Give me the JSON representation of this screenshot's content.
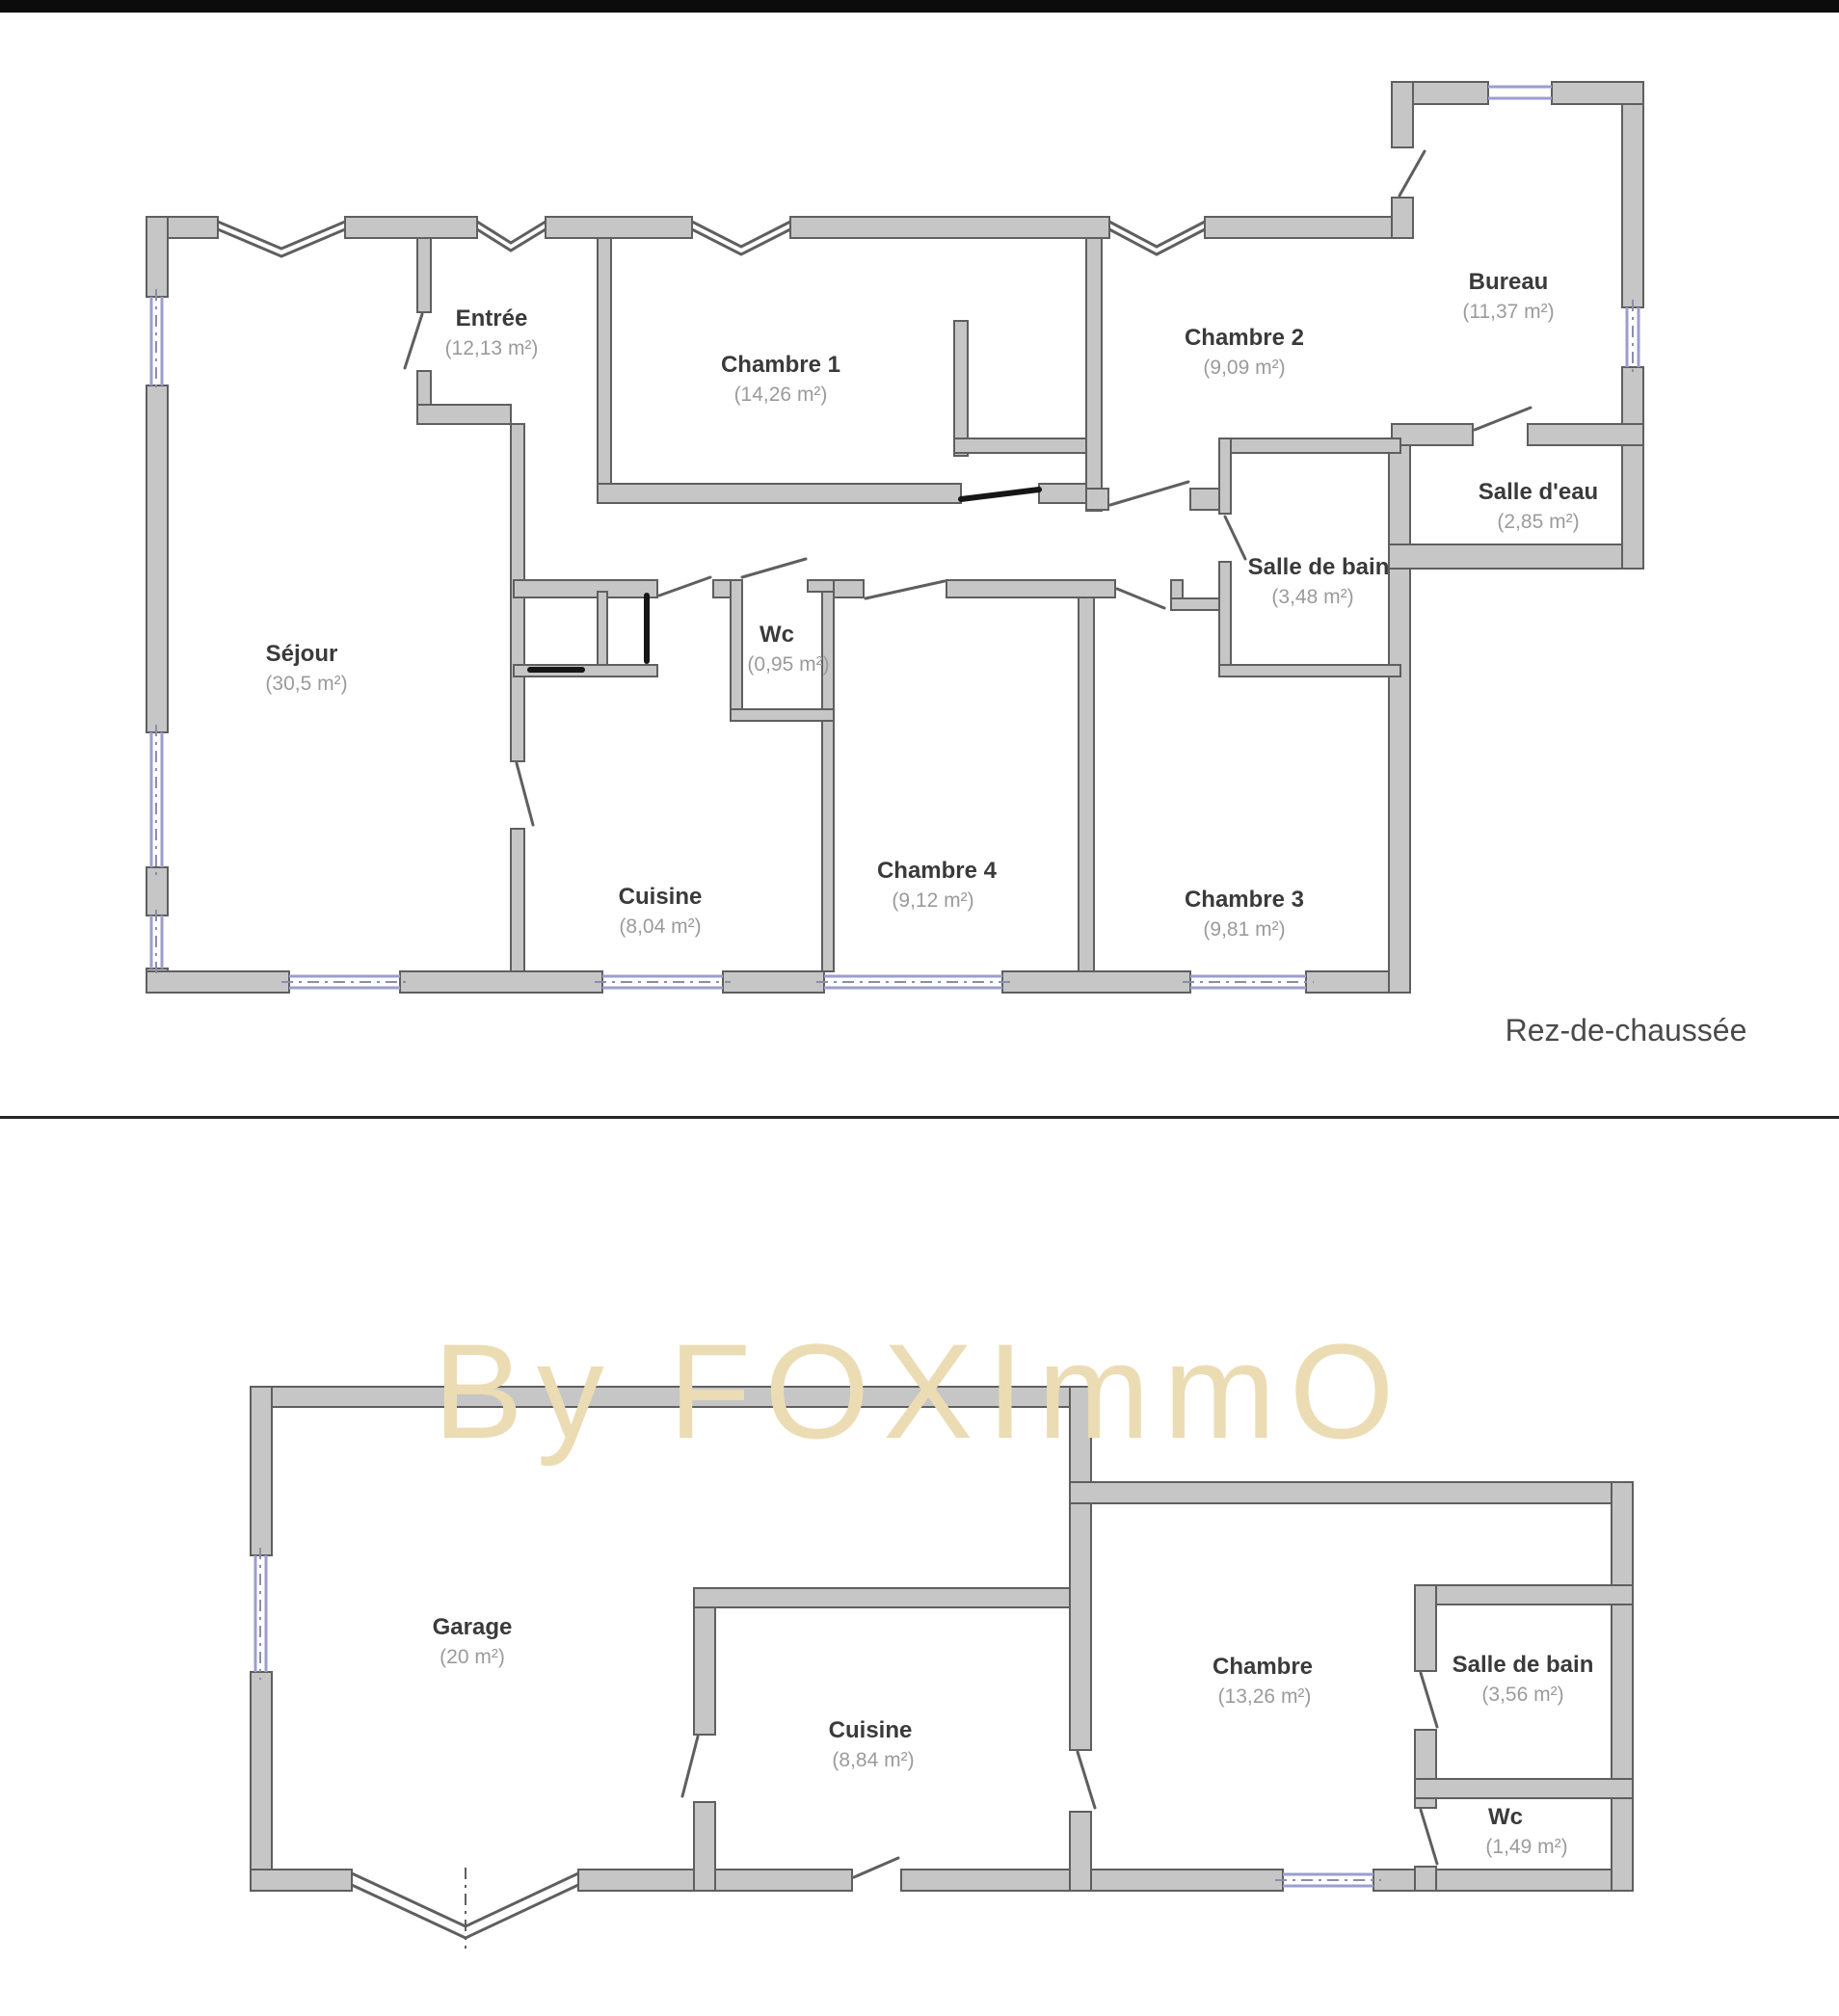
{
  "watermark": {
    "text": "By FOXImmO"
  },
  "floor1": {
    "caption": "Rez-de-chaussée",
    "rooms": [
      {
        "id": "sejour",
        "name": "Séjour",
        "area": "(30,5 m²)"
      },
      {
        "id": "entree",
        "name": "Entrée",
        "area": "(12,13 m²)"
      },
      {
        "id": "chambre-1",
        "name": "Chambre 1",
        "area": "(14,26 m²)"
      },
      {
        "id": "chambre-2",
        "name": "Chambre 2",
        "area": "(9,09 m²)"
      },
      {
        "id": "bureau",
        "name": "Bureau",
        "area": "(11,37 m²)"
      },
      {
        "id": "salle-d-eau",
        "name": "Salle d'eau",
        "area": "(2,85 m²)"
      },
      {
        "id": "salle-de-bain",
        "name": "Salle de bain",
        "area": "(3,48 m²)"
      },
      {
        "id": "wc",
        "name": "Wc",
        "area": "(0,95 m²)"
      },
      {
        "id": "cuisine",
        "name": "Cuisine",
        "area": "(8,04 m²)"
      },
      {
        "id": "chambre-4",
        "name": "Chambre 4",
        "area": "(9,12 m²)"
      },
      {
        "id": "chambre-3",
        "name": "Chambre 3",
        "area": "(9,81 m²)"
      }
    ]
  },
  "floor2": {
    "rooms": [
      {
        "id": "garage",
        "name": "Garage",
        "area": "(20 m²)"
      },
      {
        "id": "cuisine-2",
        "name": "Cuisine",
        "area": "(8,84 m²)"
      },
      {
        "id": "chambre",
        "name": "Chambre",
        "area": "(13,26 m²)"
      },
      {
        "id": "salle-de-bain-2",
        "name": "Salle de bain",
        "area": "(3,56 m²)"
      },
      {
        "id": "wc-2",
        "name": "Wc",
        "area": "(1,49 m²)"
      }
    ]
  },
  "colors": {
    "top_bar": "#0c0c0c",
    "divider": "#262626",
    "wall_fill": "#c6c6c6",
    "wall_stroke": "#5f5f5f",
    "window": "#9b9ece",
    "window_dash": "#8a8fa8",
    "door": "#5f5f5f",
    "door_dark": "#161616",
    "room_name": "#3a3a3a",
    "room_area": "#9b9b9b",
    "caption": "#4a4a4a",
    "watermark": "#ecdcb3"
  }
}
